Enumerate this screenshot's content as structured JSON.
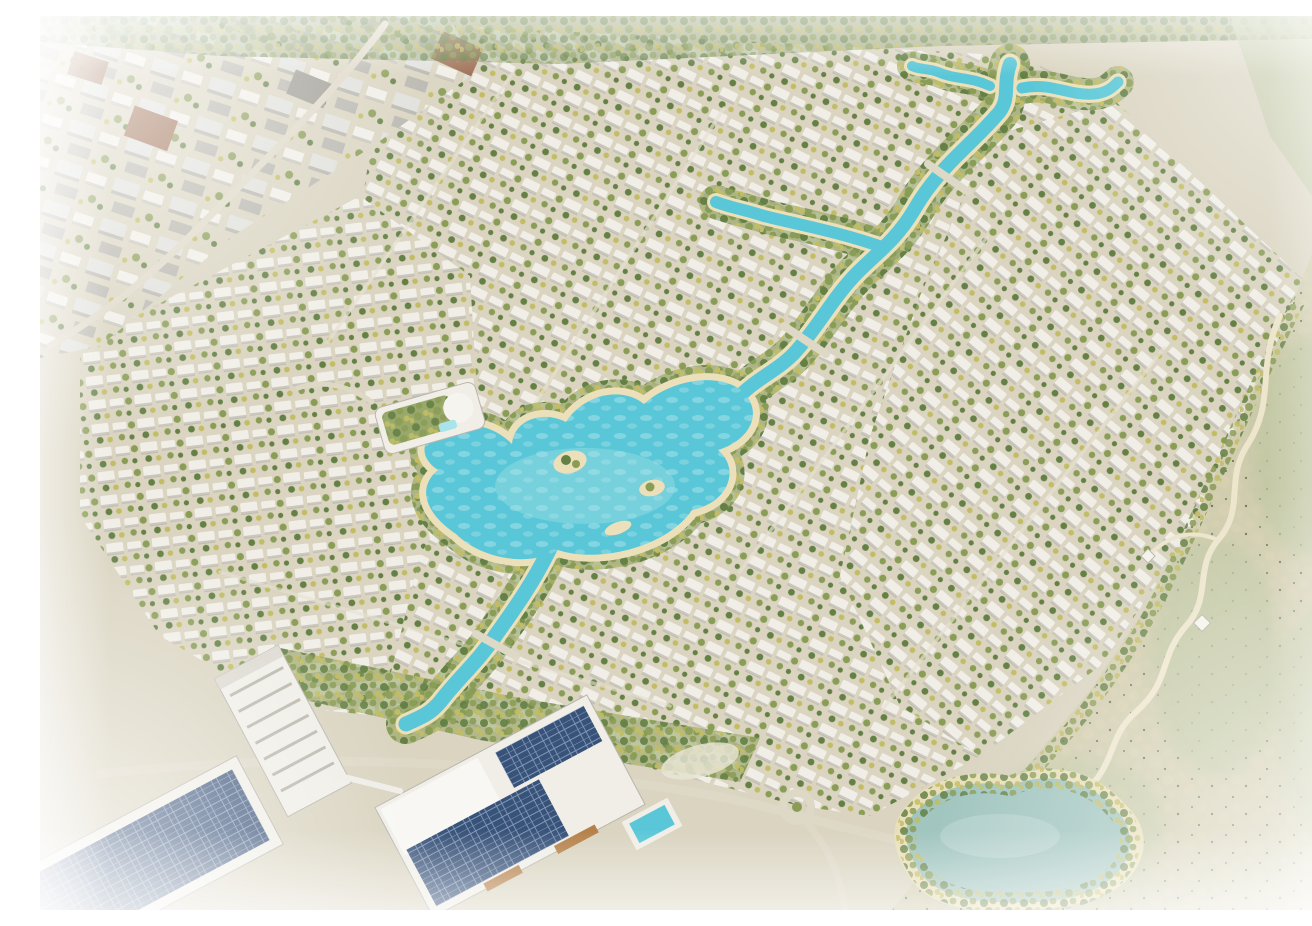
{
  "scene": {
    "description": "Aerial architectural rendering of a large master-planned villa community: rows of white villas and townhouses fan out around a winding turquoise lagoon with sandy beaches and palm-lined banks; a canal crosses the community from the upper right to a central swimmable lagoon and continues south; mid-rise apartment blocks sit in the upper left; a school and commercial campus with rooftop solar panels occupies the lower left; a sage-green desert reserve with a winding walking trail and a natural lake borders the community on the right and bottom; the image fades to white haze at its edges",
    "type": "aerial-render",
    "visible_text": []
  },
  "palette": {
    "ground": "#d8d2bd",
    "villa_white": "#f0eee6",
    "villa_shadow": "#a8a499",
    "block_gray": "#dededa",
    "block_dark": "#b4b2aa",
    "tree_dark": "#5c7a3c",
    "tree_mid": "#84984e",
    "tree_light": "#bfba5c",
    "shrub": "#6d7053",
    "water_bright": "#52c5d6",
    "water_light": "#a5e3e9",
    "beach": "#eadfb6",
    "desert": "#cfcbab",
    "desert_sand": "#d9cfae",
    "desert_sage": "#bcc49e",
    "trail": "#ece4ca",
    "road": "#ddd6c4",
    "street": "#e5dfce",
    "solar_blue": "#2e4a72",
    "solar_grid": "#7e93b4",
    "brick": "#9a6a4e",
    "accent_orange": "#b27a40",
    "lake": "#9cc2bc",
    "haze": "#ffffff"
  },
  "regions": [
    "apartment-district-northwest",
    "villa-district-north",
    "villa-district-east",
    "villa-district-west",
    "canal-cross-junction",
    "winding-canal",
    "central-lagoon",
    "lagoon-islands",
    "south-canal",
    "clubhouse-green-roof",
    "school-campus-solar-roofs",
    "midrise-tower-southwest",
    "rooftop-pool",
    "main-road",
    "roundabout",
    "desert-reserve-east",
    "walking-trail",
    "trail-pavilions",
    "natural-lake-southeast",
    "edge-haze-vignette"
  ]
}
